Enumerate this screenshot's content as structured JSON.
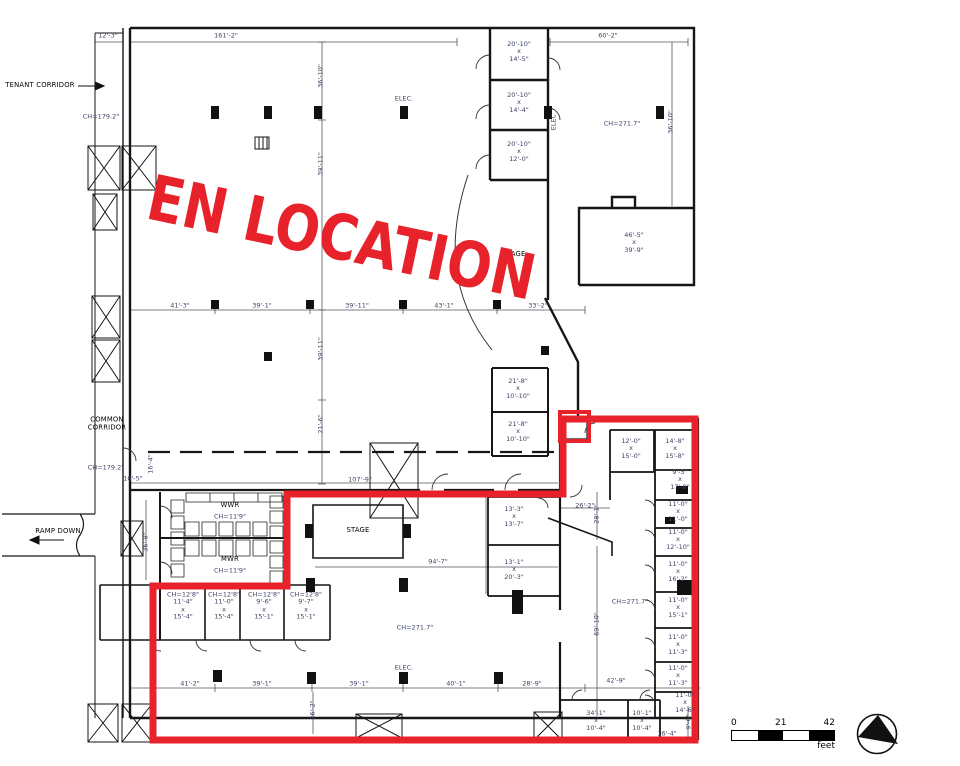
{
  "stamp": {
    "text": "EN LOCATION",
    "color": "#E8222A"
  },
  "colors": {
    "highlight": "#E8222A",
    "wall": "#161616",
    "dim_text": "#3D4366"
  },
  "scale_bar": {
    "ticks": [
      "0",
      "21",
      "42"
    ],
    "unit": "feet"
  },
  "plan_labels": [
    {
      "t": "TENANT CORRIDOR",
      "x": 40,
      "y": 86,
      "cls": "name",
      "name": "tenant-corridor-label"
    },
    {
      "t": "12'-3\"",
      "x": 108,
      "y": 36
    },
    {
      "t": "161'-2\"",
      "x": 226,
      "y": 36
    },
    {
      "t": "60'-2\"",
      "x": 608,
      "y": 36
    },
    {
      "t": "CH=179.2\"",
      "x": 101,
      "y": 117
    },
    {
      "t": "36'-10\"",
      "x": 321,
      "y": 76,
      "rot": 1
    },
    {
      "t": "39'-11\"",
      "x": 321,
      "y": 164,
      "rot": 1
    },
    {
      "t": "ELEC.",
      "x": 404,
      "y": 99
    },
    {
      "lines": [
        "20'-10\"",
        "x",
        "14'-5\""
      ],
      "x": 519,
      "y": 52,
      "name": "room-label"
    },
    {
      "lines": [
        "20'-10\"",
        "x",
        "14'-4\""
      ],
      "x": 519,
      "y": 103,
      "name": "room-label"
    },
    {
      "lines": [
        "20'-10\"",
        "x",
        "12'-0\""
      ],
      "x": 519,
      "y": 152,
      "name": "room-label"
    },
    {
      "t": "ELEC",
      "x": 554,
      "y": 122,
      "rot": 1
    },
    {
      "t": "CH=271.7\"",
      "x": 622,
      "y": 124
    },
    {
      "t": "36'-10\"",
      "x": 671,
      "y": 122,
      "rot": 1
    },
    {
      "lines": [
        "46'-5\"",
        "x",
        "39'-9\""
      ],
      "x": 634,
      "y": 243,
      "name": "room-label"
    },
    {
      "t": "STAGE",
      "x": 514,
      "y": 255,
      "cls": "name",
      "name": "stage-upper-label"
    },
    {
      "t": "41'-3\"",
      "x": 180,
      "y": 306
    },
    {
      "t": "39'-1\"",
      "x": 262,
      "y": 306
    },
    {
      "t": "39'-11\"",
      "x": 357,
      "y": 306
    },
    {
      "t": "43'-1\"",
      "x": 444,
      "y": 306
    },
    {
      "t": "33'-2\"",
      "x": 538,
      "y": 306
    },
    {
      "t": "39'-11\"",
      "x": 321,
      "y": 349,
      "rot": 1
    },
    {
      "t": "21'-6\"",
      "x": 321,
      "y": 424,
      "rot": 1
    },
    {
      "lines": [
        "21'-8\"",
        "x",
        "10'-10\""
      ],
      "x": 518,
      "y": 389,
      "name": "room-label"
    },
    {
      "lines": [
        "21'-8\"",
        "x",
        "10'-10\""
      ],
      "x": 518,
      "y": 432,
      "name": "room-label"
    },
    {
      "lines": [
        "COMMON",
        "CORRIDOR"
      ],
      "x": 107,
      "y": 424,
      "cls": "name",
      "name": "common-corridor-label"
    },
    {
      "t": "CH=179.2\"",
      "x": 106,
      "y": 468
    },
    {
      "t": "10'-5\"",
      "x": 133,
      "y": 479
    },
    {
      "t": "16'-4\"",
      "x": 151,
      "y": 464,
      "rot": 1
    },
    {
      "t": "36'-8\"",
      "x": 146,
      "y": 542,
      "rot": 1
    },
    {
      "t": "RAMP DOWN",
      "x": 58,
      "y": 532,
      "cls": "name",
      "name": "ramp-down-label"
    },
    {
      "t": "107'-9\"",
      "x": 360,
      "y": 480
    },
    {
      "t": "WWR",
      "x": 230,
      "y": 506,
      "cls": "name",
      "name": "wwr-label"
    },
    {
      "t": "CH=11'9\"",
      "x": 230,
      "y": 517
    },
    {
      "t": "MWR",
      "x": 230,
      "y": 560,
      "cls": "name",
      "name": "mwr-label"
    },
    {
      "t": "CH=11'9\"",
      "x": 230,
      "y": 571
    },
    {
      "t": "STAGE",
      "x": 358,
      "y": 531,
      "cls": "name",
      "name": "stage-label"
    },
    {
      "t": "94'-7\"",
      "x": 438,
      "y": 562
    },
    {
      "lines": [
        "CH=12'8\"",
        "11'-4\"",
        "x",
        "15'-4\""
      ],
      "x": 183,
      "y": 606,
      "name": "room-label"
    },
    {
      "lines": [
        "CH=12'8\"",
        "11'-0\"",
        "x",
        "15'-4\""
      ],
      "x": 224,
      "y": 606,
      "name": "room-label"
    },
    {
      "lines": [
        "CH=12'8\"",
        "9'-6\"",
        "x",
        "15'-1\""
      ],
      "x": 264,
      "y": 606,
      "name": "room-label"
    },
    {
      "lines": [
        "CH=12'8\"",
        "9'-7\"",
        "x",
        "15'-1\""
      ],
      "x": 306,
      "y": 606,
      "name": "room-label"
    },
    {
      "t": "CH=271.7\"",
      "x": 415,
      "y": 628
    },
    {
      "t": "26'-2\"",
      "x": 313,
      "y": 710,
      "rot": 1
    },
    {
      "lines": [
        "13'-3\"",
        "x",
        "13'-7\""
      ],
      "x": 514,
      "y": 517,
      "name": "room-label"
    },
    {
      "lines": [
        "13'-1\"",
        "x",
        "20'-3\""
      ],
      "x": 514,
      "y": 570,
      "name": "room-label"
    },
    {
      "t": "26'-2\"",
      "x": 585,
      "y": 506
    },
    {
      "t": "28'-1\"",
      "x": 597,
      "y": 514,
      "rot": 1
    },
    {
      "t": "69'-10\"",
      "x": 597,
      "y": 624,
      "rot": 1
    },
    {
      "lines": [
        "12'-0\"",
        "x",
        "15'-0\""
      ],
      "x": 631,
      "y": 449,
      "name": "room-label"
    },
    {
      "lines": [
        "14'-8\"",
        "x",
        "15'-8\""
      ],
      "x": 675,
      "y": 449,
      "name": "room-label"
    },
    {
      "lines": [
        "9'-5\"",
        "x",
        "17'-8\""
      ],
      "x": 680,
      "y": 480,
      "name": "room-label"
    },
    {
      "lines": [
        "11'-0\"",
        "x",
        "11'-0\""
      ],
      "x": 678,
      "y": 512,
      "name": "room-label"
    },
    {
      "lines": [
        "11'-0\"",
        "x",
        "12'-10\""
      ],
      "x": 678,
      "y": 540,
      "name": "room-label"
    },
    {
      "lines": [
        "11'-0\"",
        "x",
        "16'-2\""
      ],
      "x": 678,
      "y": 572,
      "name": "room-label"
    },
    {
      "lines": [
        "11'-0\"",
        "x",
        "15'-1\""
      ],
      "x": 678,
      "y": 608,
      "name": "room-label"
    },
    {
      "lines": [
        "11'-0\"",
        "x",
        "11'-3\""
      ],
      "x": 678,
      "y": 645,
      "name": "room-label"
    },
    {
      "lines": [
        "11'-0\"",
        "x",
        "11'-3\""
      ],
      "x": 678,
      "y": 676,
      "name": "room-label"
    },
    {
      "lines": [
        "11'-0\"",
        "x",
        "14'-6\""
      ],
      "x": 685,
      "y": 703,
      "name": "room-label"
    },
    {
      "t": "CH=271.7\"",
      "x": 630,
      "y": 602
    },
    {
      "t": "ELEC.",
      "x": 404,
      "y": 668
    },
    {
      "t": "41'-2\"",
      "x": 190,
      "y": 684
    },
    {
      "t": "39'-1\"",
      "x": 262,
      "y": 684
    },
    {
      "t": "39'-1\"",
      "x": 359,
      "y": 684
    },
    {
      "t": "40'-1\"",
      "x": 456,
      "y": 684
    },
    {
      "t": "28'-9\"",
      "x": 532,
      "y": 684
    },
    {
      "t": "42'-9\"",
      "x": 616,
      "y": 681
    },
    {
      "lines": [
        "34'-1\"",
        "x",
        "10'-4\""
      ],
      "x": 596,
      "y": 721,
      "name": "room-label"
    },
    {
      "lines": [
        "10'-1\"",
        "x",
        "10'-4\""
      ],
      "x": 642,
      "y": 721,
      "name": "room-label"
    },
    {
      "t": "16'-4\"",
      "x": 667,
      "y": 734
    },
    {
      "t": "9'-6\"",
      "x": 689,
      "y": 722,
      "rot": 1
    }
  ]
}
